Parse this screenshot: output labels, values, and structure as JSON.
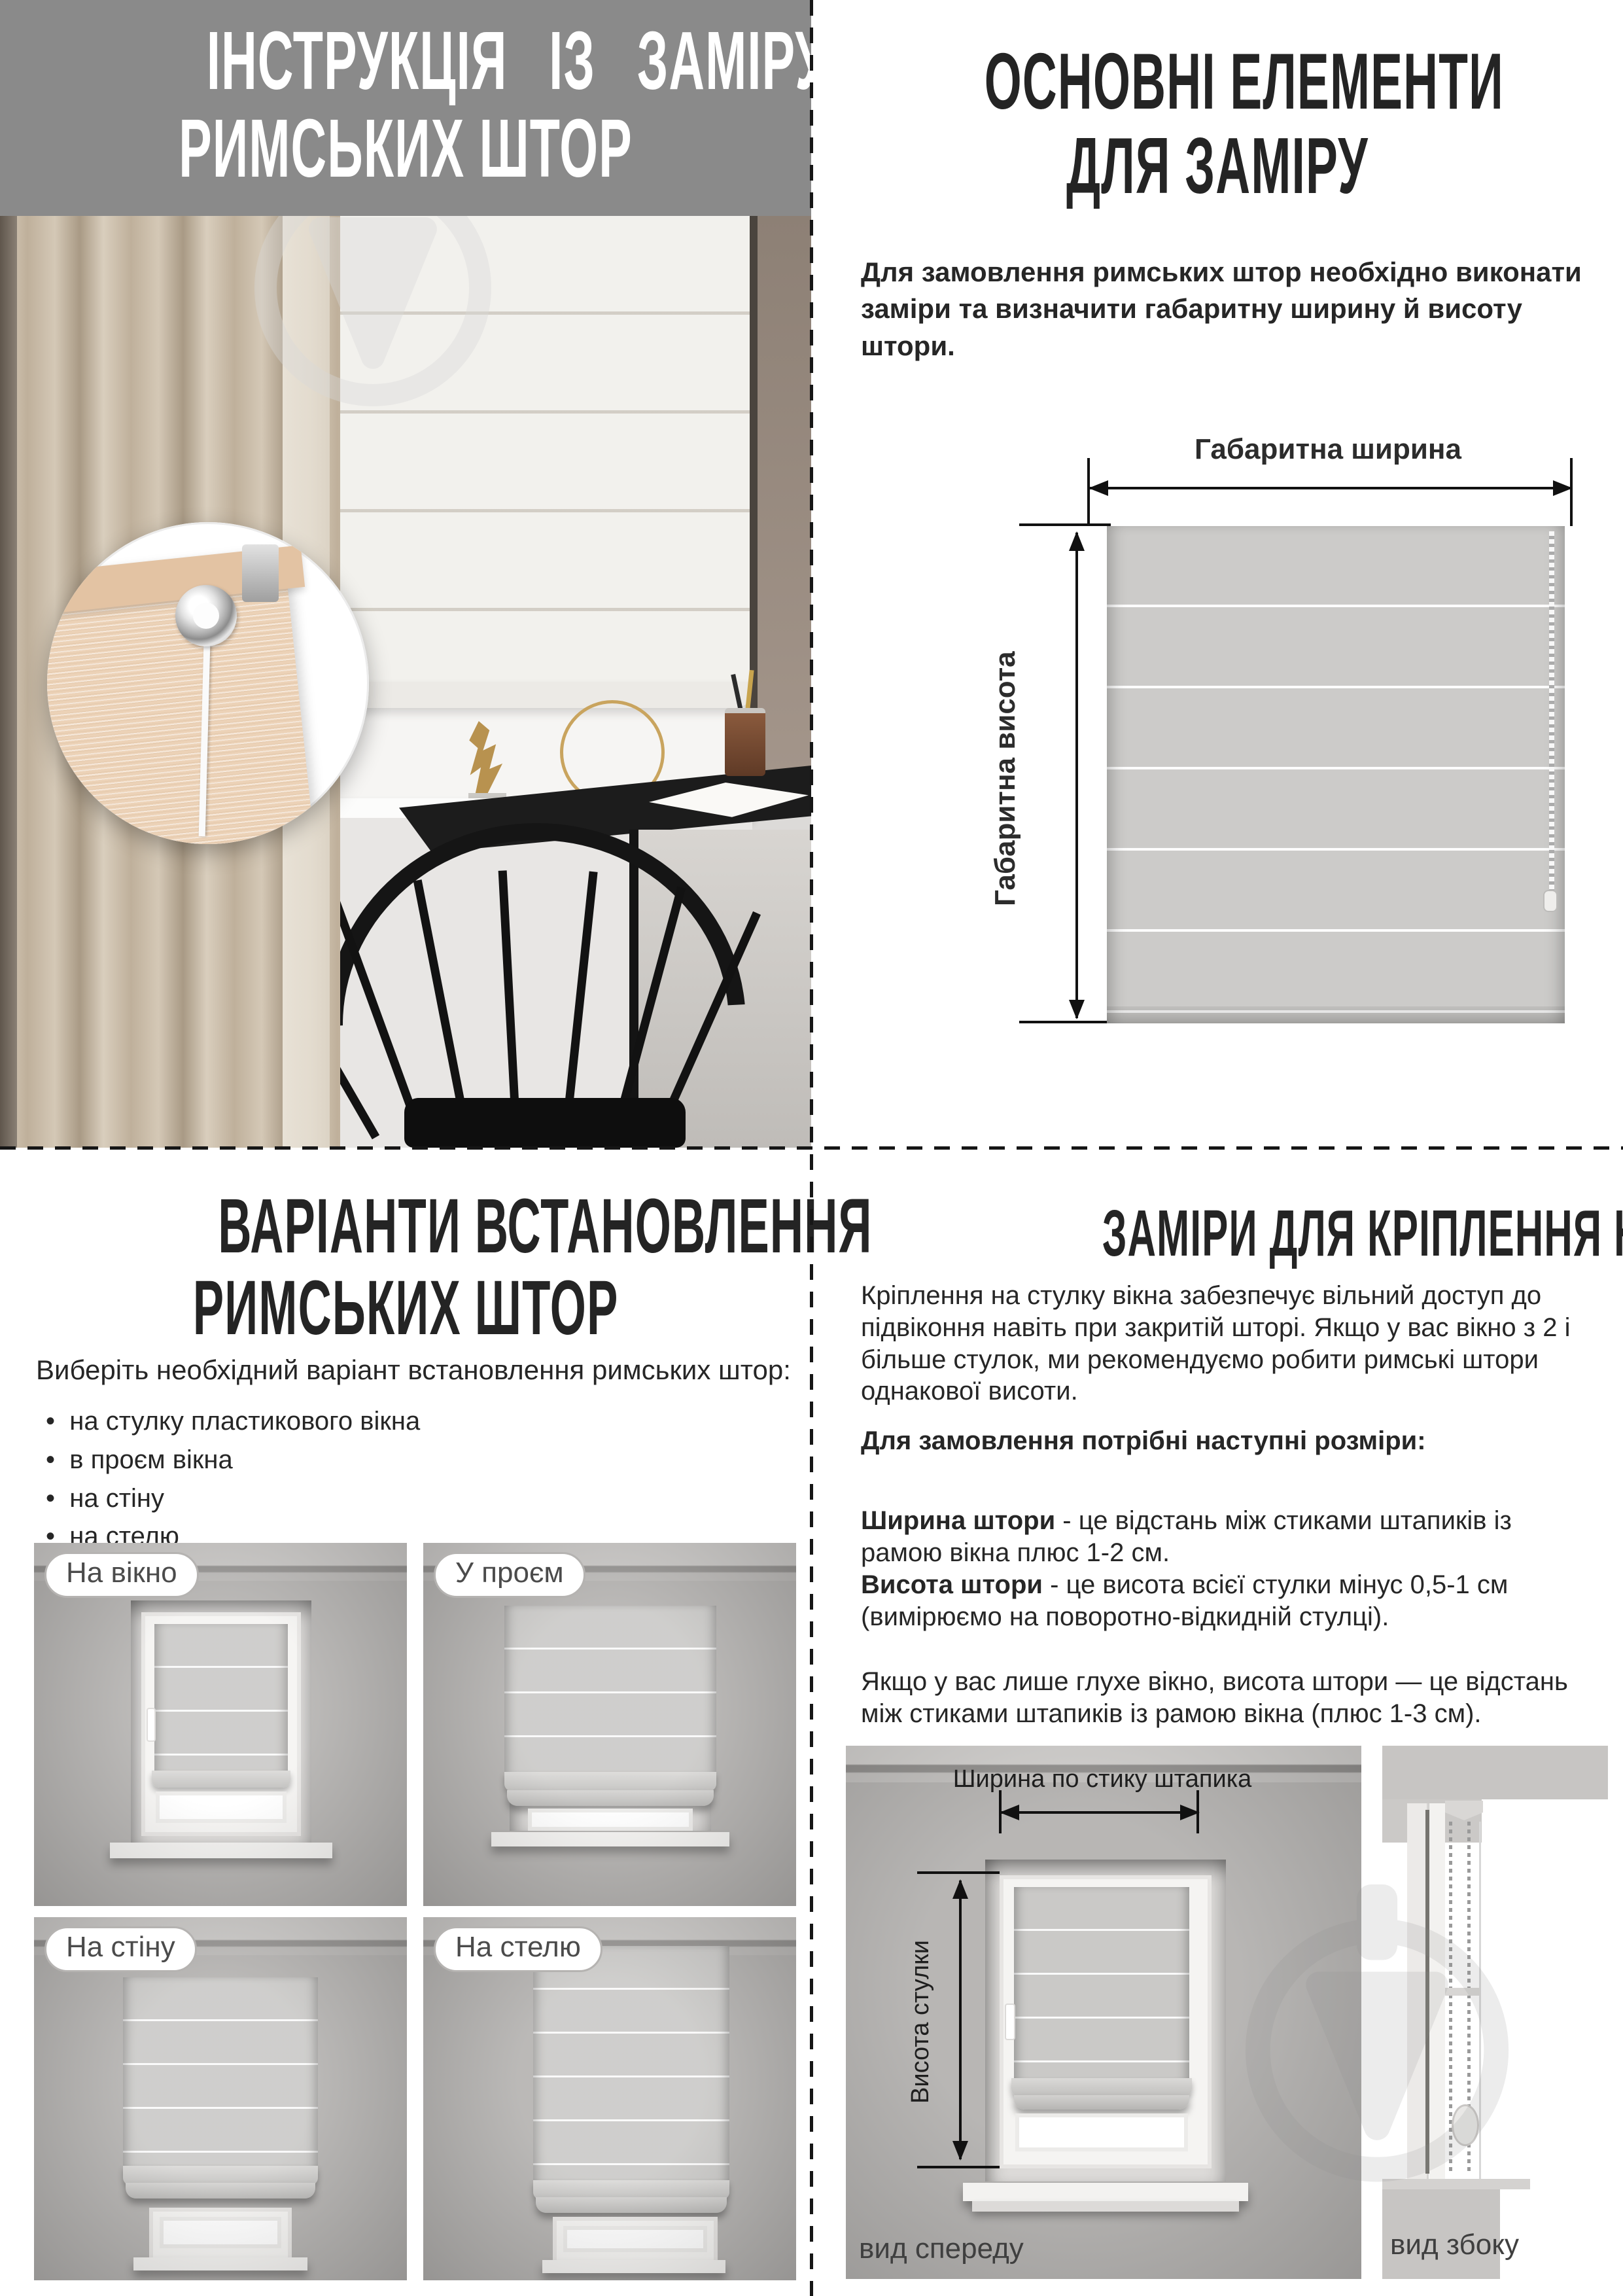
{
  "colors": {
    "band_gray": "#8a8a8a",
    "heading_dark": "#242424",
    "body_text": "#262626",
    "blind_fabric": "#cac9c7",
    "curtain_beige": "#c4b6a2",
    "arrow_black": "#111111",
    "wall_gray": "#b3b1af"
  },
  "tl": {
    "title_line1": "ІНСТРУКЦІЯ ІЗ ЗАМІРУ",
    "title_line2": "РИМСЬКИХ ШТОР"
  },
  "tr": {
    "title_line1": "ОСНОВНІ ЕЛЕМЕНТИ",
    "title_line2": "ДЛЯ ЗАМІРУ",
    "intro": "Для замовлення римських штор необхідно виконати заміри та визначити габаритну ширину й висоту штори.",
    "width_label": "Габаритна ширина",
    "height_label": "Габаритна висота"
  },
  "bl": {
    "title_line1": "ВАРІАНТИ ВСТАНОВЛЕННЯ",
    "title_line2": "РИМСЬКИХ ШТОР",
    "subtitle": "Виберіть необхідний варіант встановлення римських штор:",
    "bullets": [
      "на стулку пластикового вікна",
      "в проєм вікна",
      "на стіну",
      "на стелю"
    ],
    "variants": [
      {
        "label": "На вікно"
      },
      {
        "label": "У проєм"
      },
      {
        "label": "На стіну"
      },
      {
        "label": "На стелю"
      }
    ]
  },
  "br": {
    "title": "ЗАМІРИ ДЛЯ КРІПЛЕННЯ НА СТУЛКУ ВІКНА",
    "para1": "Кріплення на стулку вікна забезпечує вільний доступ до підвіконня навіть при закритій шторі. Якщо у вас вікно з 2 і більше стулок, ми рекомендуємо робити римські штори однакової висоти.",
    "lead": "Для замовлення потрібні наступні розміри:",
    "width_term": "Ширина штори",
    "width_def": " - це відстань між стиками штапиків із рамою вікна плюс 1-2 см.",
    "height_term": "Висота штори",
    "height_def": " - це висота всієї стулки мінус 0,5-1 см (вимірюємо на поворотно-відкидній стулці).",
    "para2": "Якщо у вас лише глухе вікно, висота штори — це відстань між стиками штапиків із рамою вікна (плюс 1-3 см).",
    "front_width_label": "Ширина по стику штапика",
    "front_height_label": "Висота стулки",
    "front_caption": "вид спереду",
    "side_caption": "вид збоку"
  }
}
